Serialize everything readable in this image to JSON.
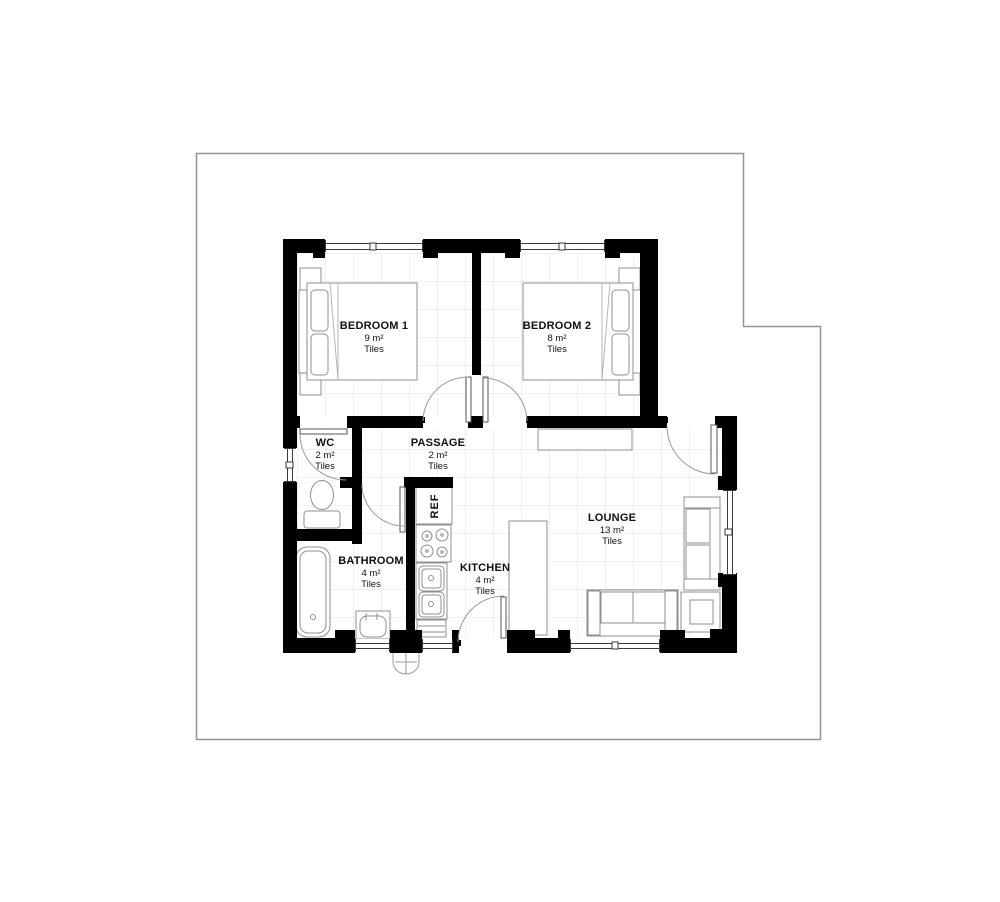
{
  "rooms": [
    {
      "name": "BEDROOM 1",
      "area": "9 m²",
      "floor": "Tiles"
    },
    {
      "name": "BEDROOM 2",
      "area": "8 m²",
      "floor": "Tiles"
    },
    {
      "name": "WC",
      "area": "2 m²",
      "floor": "Tiles"
    },
    {
      "name": "PASSAGE",
      "area": "2 m²",
      "floor": "Tiles"
    },
    {
      "name": "BATHROOM",
      "area": "4 m²",
      "floor": "Tiles"
    },
    {
      "name": "KITCHEN",
      "area": "4 m²",
      "floor": "Tiles"
    },
    {
      "name": "LOUNGE",
      "area": "13 m²",
      "floor": "Tiles"
    }
  ],
  "fixtures": {
    "fridge_label": "REF"
  },
  "colors": {
    "wall": "#000000",
    "boundary": "#949494",
    "grid": "#e2e2e2",
    "furniture": "#8f8f8f",
    "text": "#111111"
  }
}
